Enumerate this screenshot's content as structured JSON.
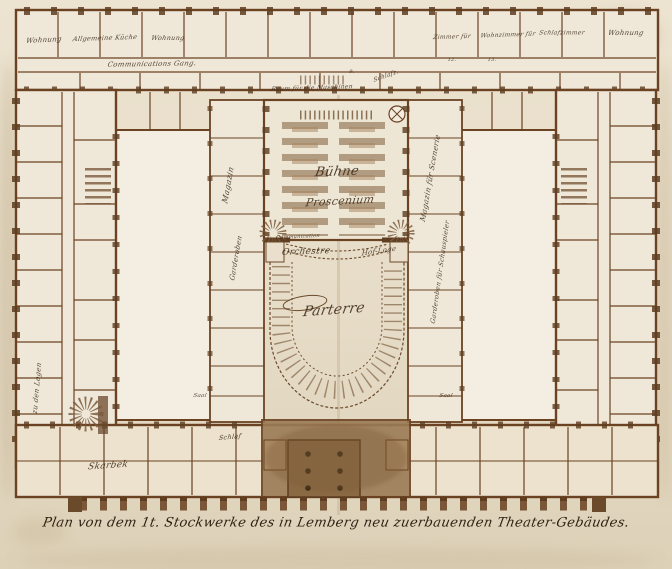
{
  "plan": {
    "caption": "Plan von dem 1t. Stockwerke des in Lemberg neu zuerbauenden Theater-Gebäudes.",
    "labels": {
      "buehne": "Bühne",
      "proscenium": "Proscenium",
      "communication": "Communication",
      "orchestre": "Orchestre",
      "hof_loge": "Hof-Loge",
      "parterre": "Parterre",
      "wohnung_left": "Wohnung",
      "kueche": "Allgemeine Küche",
      "wohnung_mid": "Wohnung",
      "communications_gang": "Communications Gang.",
      "zimmer_fuer": "Zimmer für",
      "wohnzimmer": "Wohnzimmer für",
      "schlafzimmer": "Schlafzimmer",
      "wohnung_right": "Wohnung",
      "raum_maschinen": "Raum für die Maschinen",
      "schlafz": "Schlafz.",
      "magazin_links": "Magazin",
      "garderoben_links": "Garderoben",
      "magazin_scenerie": "Magazin für Scenerie",
      "garderoben_schauspieler": "Garderoben für Schauspieler",
      "zu_den_logen": "zu den Logen",
      "saal_links": "Saal",
      "saal_rechts": "Saal",
      "schlaf": "Schlaf",
      "skarbek": "Skarbek"
    },
    "numbers": {
      "n9": "9.",
      "n12": "12.",
      "n13": "13."
    },
    "colors": {
      "ink": "#6b4323",
      "wash": "#9a7a55",
      "paper": "#e7ddc9"
    }
  }
}
